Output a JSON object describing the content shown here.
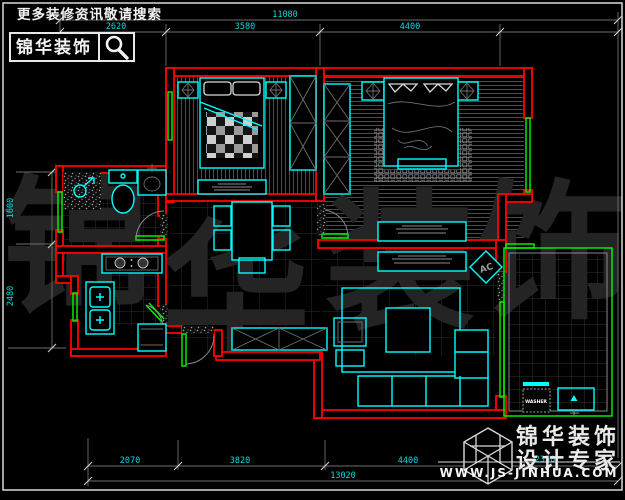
{
  "promo": {
    "search_prompt": "更多装修资讯敬请搜索",
    "logo_text": "锦华装饰"
  },
  "watermark": {
    "char1": "锦",
    "char2": "华",
    "char3": "装",
    "char4": "饰"
  },
  "plan_labels": {
    "ac": "AC",
    "washer": "WASHER"
  },
  "dimensions": {
    "top_total": "11080",
    "top_seg1": "2620",
    "top_seg2": "3580",
    "top_seg3": "4400",
    "left_seg1": "1600",
    "left_seg2": "2480",
    "bottom_seg1": "2070",
    "bottom_seg2": "3820",
    "bottom_seg3": "4400",
    "bottom_seg4": "2350",
    "bottom_total": "13020"
  },
  "brand": {
    "line1": "锦华装饰",
    "line2": "设计专家",
    "website": "WWW.JS-JINHUA.COM"
  },
  "colors": {
    "wall": "#ff0000",
    "furniture": "#00ffff",
    "window": "#00ee00",
    "dimension_text": "#00dcdc",
    "background": "#000000",
    "frame": "#d9d9d9",
    "watermark": "#242424"
  }
}
